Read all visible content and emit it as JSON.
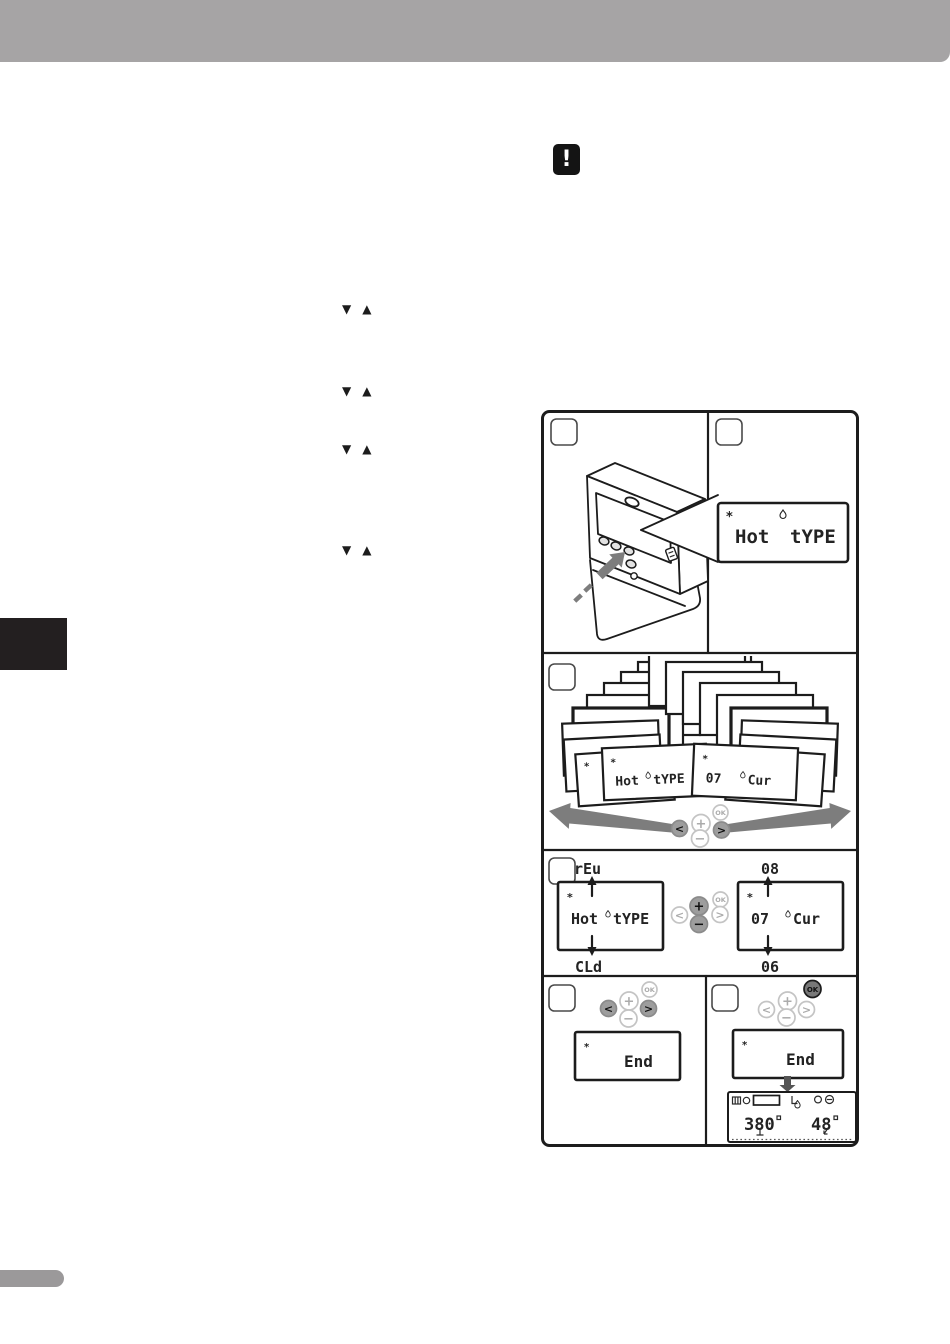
{
  "colors": {
    "header-gray": "#a6a4a5",
    "side-tab": "#231f20",
    "footer-gray": "#9b999a",
    "line": "#1c1c1c",
    "button-highlight": "#9d9d9d",
    "arrow-gray": "#7d7d7d"
  },
  "symbols": {
    "down_arrow": "▼",
    "up_arrow": "▲",
    "exclamation": "!",
    "asterisk": "*"
  },
  "controls": {
    "left": "<",
    "plus": "+",
    "ok": "OK",
    "minus": "−",
    "right": ">"
  },
  "lcd": {
    "menu_word1": "Hot",
    "menu_word2": "tYPE",
    "value_num": "07",
    "value_word": "Cur",
    "menu_option_up": "rEu",
    "menu_option_down": "CLd",
    "value_option_up": "08",
    "value_option_down": "06",
    "end_word": "End",
    "home_temp": "380",
    "home_setpoint": "48",
    "fragment_top": "t"
  }
}
